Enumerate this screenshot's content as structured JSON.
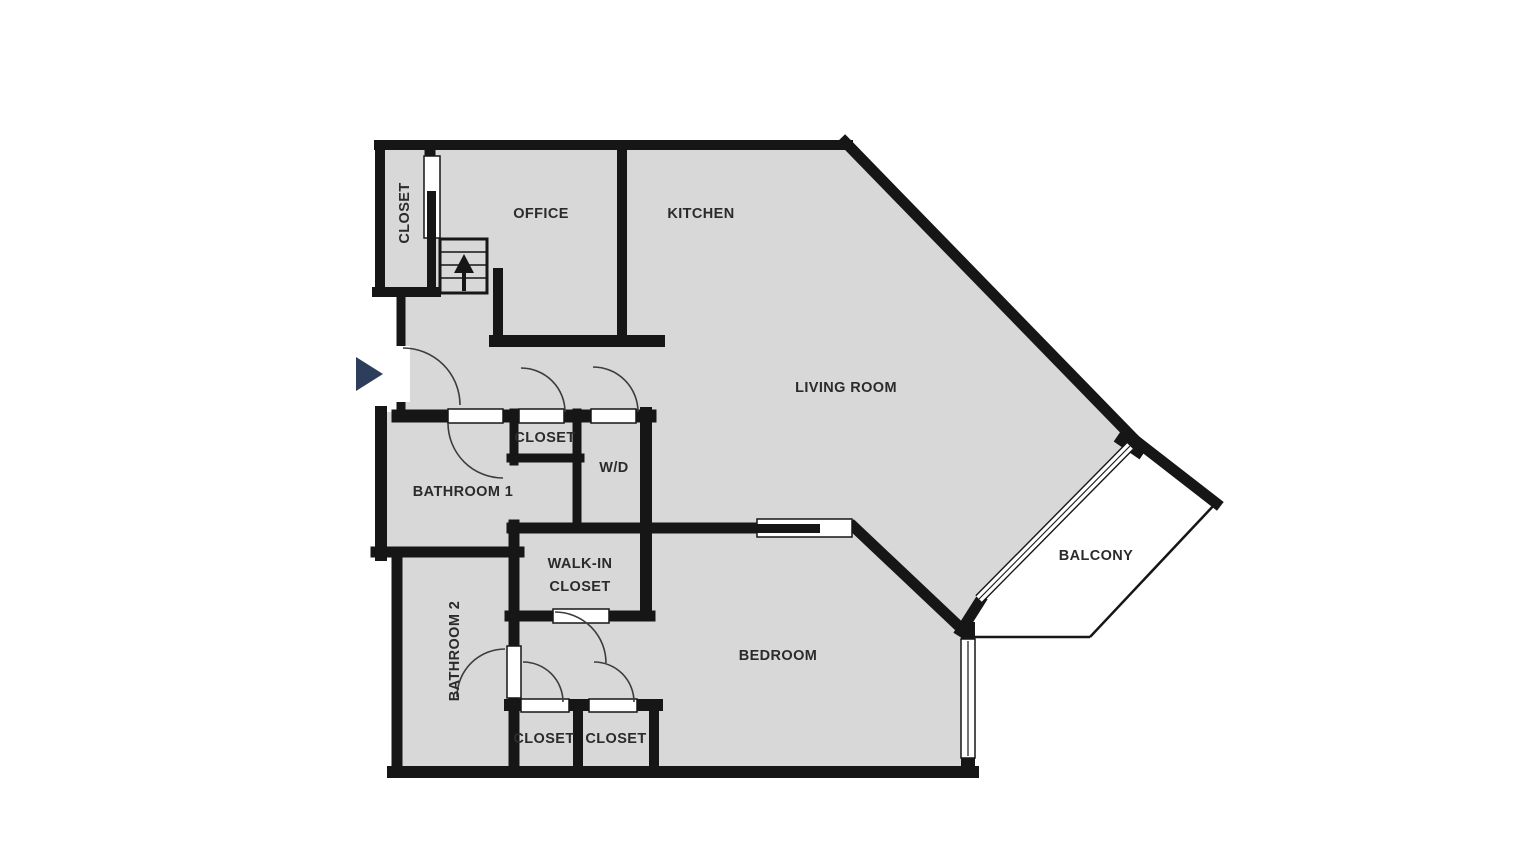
{
  "canvas": {
    "width": 1520,
    "height": 853,
    "background": "#ffffff"
  },
  "colors": {
    "floor": "#d8d8d8",
    "wall": "#161616",
    "door_arc": "#3c3c3c",
    "label": "#2b2b2b",
    "entry_marker": "#2c3e5c",
    "door_leaf_fill": "#ffffff"
  },
  "rooms": {
    "closet_top": {
      "label": "CLOSET"
    },
    "office": {
      "label": "OFFICE"
    },
    "kitchen": {
      "label": "KITCHEN"
    },
    "living_room": {
      "label": "LIVING ROOM"
    },
    "hall_closet": {
      "label": "CLOSET"
    },
    "washer_dryer": {
      "label": "W/D"
    },
    "bathroom_1": {
      "label": "BATHROOM 1"
    },
    "walk_in_closet": {
      "label_line_1": "WALK-IN",
      "label_line_2": "CLOSET"
    },
    "bathroom_2": {
      "label": "BATHROOM 2"
    },
    "bedroom": {
      "label": "BEDROOM"
    },
    "closet_bottom_left": {
      "label": "CLOSET"
    },
    "closet_bottom_right": {
      "label": "CLOSET"
    },
    "balcony": {
      "label": "BALCONY"
    }
  },
  "icons": {
    "entry_marker": "right-pointing-triangle",
    "stairs_arrow": "up-arrow"
  }
}
